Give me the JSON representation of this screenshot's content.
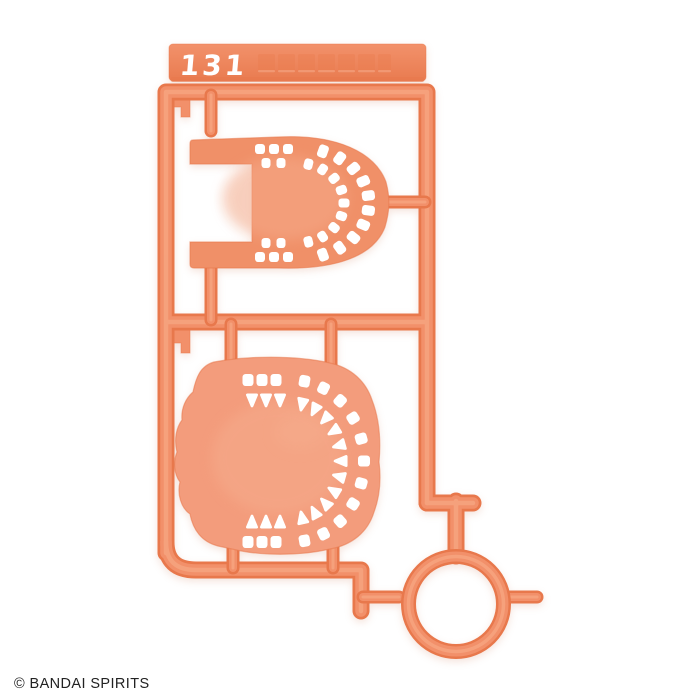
{
  "photo": {
    "background": "#FFFFFF",
    "runner": {
      "number": "131",
      "embossed_marking_glyphs": 7,
      "parts": [
        {
          "name": "perforated shell part upper"
        },
        {
          "name": "perforated shell part lower"
        },
        {
          "name": "ring part"
        }
      ]
    },
    "colors": {
      "background": "#FFFFFF",
      "plastic_dark": "#E8784C",
      "plastic_mid": "#F2906A",
      "plastic_highlight": "#F6A37E",
      "part_upper": "#F09068",
      "part_lower": "#F39C7C",
      "part_light": "#F6AC8C",
      "bar_top": "#F2916A",
      "bar_bottom": "#E97B50",
      "hole": "#FFFFFF",
      "number_text": "#FFFFFF",
      "copyright_text": "#222222"
    },
    "copyright": "© BANDAI SPIRITS"
  }
}
